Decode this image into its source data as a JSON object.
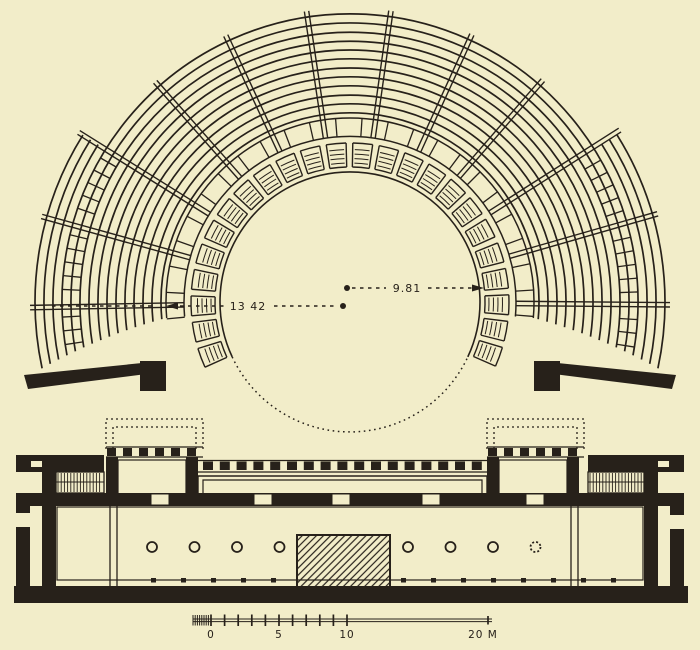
{
  "figure": {
    "type": "architectural-plan",
    "subject": "Ground plan of an ancient Greek theatre: semicircular cavea with radial stairways, proedria ring, circular orchestra, and stage building with paraskenia",
    "colors": {
      "background": "#f2edc9",
      "ink": "#27211a"
    },
    "annotations": {
      "cavea_radius_label": "13 42",
      "orchestra_radius_label": "9.81"
    },
    "scale_bar": {
      "labels": {
        "zero": "0",
        "five": "5",
        "ten": "10",
        "end": "20 M"
      }
    }
  }
}
